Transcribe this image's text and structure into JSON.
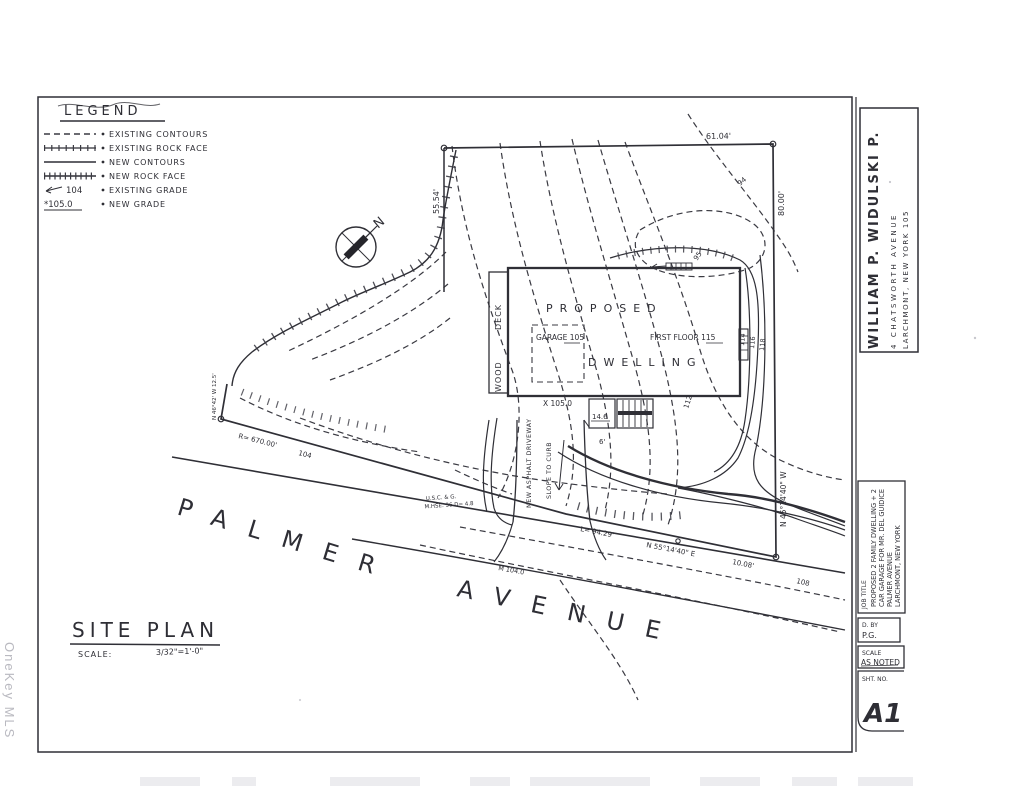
{
  "watermark": "OneKey MLS",
  "legend": {
    "title": "LEGEND",
    "items": [
      {
        "label": "EXISTING CONTOURS"
      },
      {
        "label": "EXISTING ROCK FACE"
      },
      {
        "label": "NEW CONTOURS"
      },
      {
        "label": "NEW ROCK FACE"
      },
      {
        "label": "EXISTING GRADE",
        "sample": "104"
      },
      {
        "label": "NEW GRADE",
        "sample": "*105.0"
      }
    ]
  },
  "north": {
    "label": "N"
  },
  "street": {
    "word1": "PALMER",
    "word2": "AVENUE"
  },
  "building": {
    "name_line1": "PROPOSED",
    "name_line2": "DWELLING",
    "garage": "GARAGE 105",
    "first_floor": "FIRST FLOOR  115",
    "deck_word1": "DECK",
    "deck_word2": "WOOD",
    "stoop_dim": "14.6",
    "steps_dim": "6'"
  },
  "boundary": {
    "dim_top": "61.04'",
    "dim_right": "80.00'",
    "dim_left": "55.54'",
    "bearing_right": "N 45°14'40\" W",
    "bearing_bottom": "N 55°14'40\" E",
    "tie": "10.08'",
    "arc": "L= 94.29'",
    "radius": "R= 670.00'",
    "jog": "N 46°42' W  12.5'"
  },
  "grades": {
    "g94": "94",
    "g95": "95",
    "g104": "104",
    "g108": "108",
    "g112": "112",
    "g114": "114",
    "g116": "116",
    "g118": "118",
    "spot_road": "M 104.0",
    "spot_yard": "X 105.0"
  },
  "notes": {
    "driveway": "NEW ASPHALT DRIVEWAY",
    "slope": "SLOPE TO CURB",
    "uscg1": "U.S.C. & G.",
    "uscg2": "M.HSE. 36  D= 4.8"
  },
  "plan_title": {
    "title": "SITE PLAN",
    "scale_label": "SCALE:",
    "scale_value": "3/32\"=1'-0\""
  },
  "title_block": {
    "architect": "WILLIAM  P.  WIDULSKI  P.",
    "address1": "4  CHATSWORTH  AVENUE",
    "address2": "LARCHMONT,  NEW  YORK  105",
    "job_title_label": "JOB TITLE",
    "job_line1": "PROPOSED 2 FAMILY DWELLING + 2",
    "job_line2": "CAR GARAGE FOR MR. DEL GUIDICE",
    "job_line3": "PALMER AVENUE",
    "job_line4": "LARCHMONT, NEW YORK",
    "drawn_by_label": "D. BY",
    "drawn_by": "P.G.",
    "scale_label": "SCALE",
    "scale_value": "AS NOTED",
    "sheet_label": "SHT. NO.",
    "sheet_number": "A1"
  }
}
